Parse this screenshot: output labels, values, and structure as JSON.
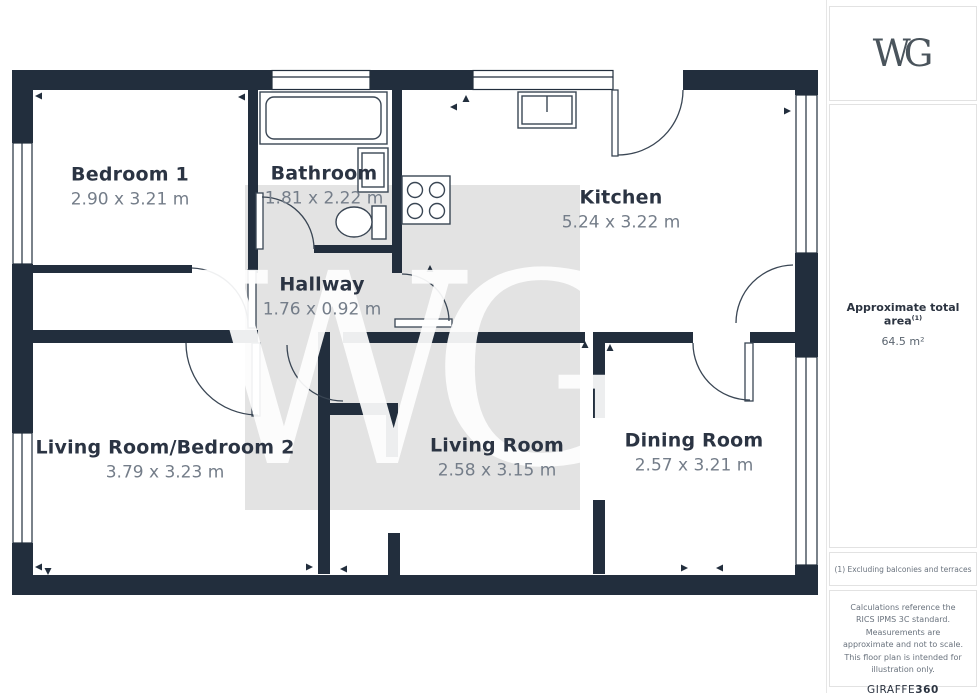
{
  "logo": {
    "text": "WG"
  },
  "watermark": {
    "letters": "WG"
  },
  "rooms": [
    {
      "name": "Bedroom 1",
      "dimensions": "2.90 x 3.21 m"
    },
    {
      "name": "Bathroom",
      "dimensions": "1.81 x 2.22 m"
    },
    {
      "name": "Kitchen",
      "dimensions": "5.24 x 3.22 m"
    },
    {
      "name": "Hallway",
      "dimensions": "1.76 x 0.92 m"
    },
    {
      "name": "Living Room/Bedroom 2",
      "dimensions": "3.79 x 3.23 m"
    },
    {
      "name": "Living Room",
      "dimensions": "2.58 x 3.15 m"
    },
    {
      "name": "Dining Room",
      "dimensions": "2.57 x 3.21 m"
    }
  ],
  "sidebar": {
    "area_label": "Approximate total area",
    "area_superscript": "(1)",
    "area_value": "64.5 m²",
    "footnote": "(1) Excluding balconies and terraces",
    "disclaimer": "Calculations reference the RICS IPMS 3C standard. Measurements are approximate and not to scale. This floor plan is intended for illustration only.",
    "brand": "GIRAFFE",
    "brand_suffix": "360"
  },
  "colors": {
    "wall": "#222e3d",
    "fixture_line": "#3a4654",
    "watermark_square": "#e3e3e3",
    "room_name": "#2b3443",
    "room_dims": "#747d89"
  }
}
